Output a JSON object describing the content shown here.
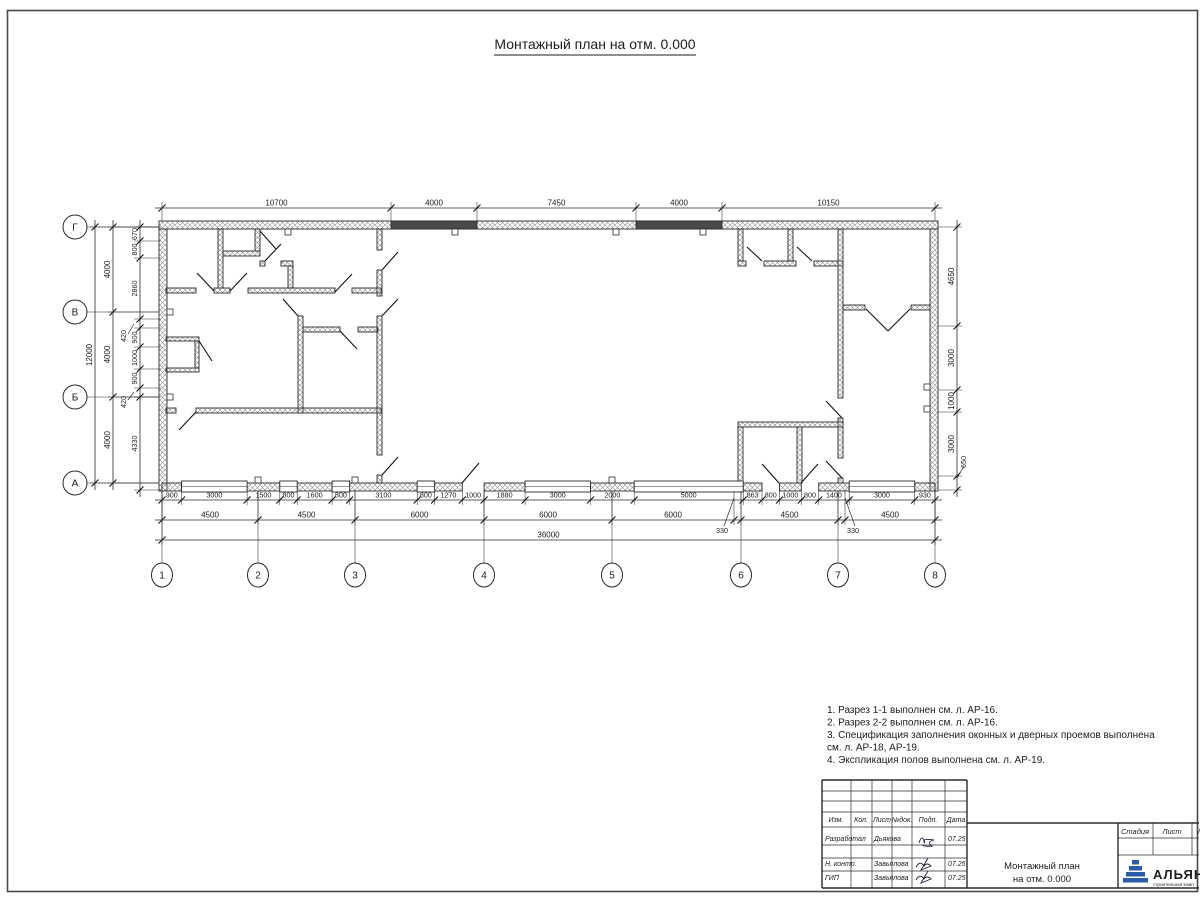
{
  "sheet": {
    "title": "Монтажный план на отм. 0.000"
  },
  "notes": {
    "lines": [
      "1. Разрез 1-1 выполнен см. л. АР-16.",
      "2. Разрез 2-2 выполнен см. л. АР-16.",
      "3. Спецификация заполнения оконных и дверных проемов выполнена",
      "см. л. АР-18, АР-19.",
      "4. Экспликация полов выполнена см. л. АР-19."
    ]
  },
  "tb": {
    "header_cols": [
      "Изм.",
      "Кол.",
      "Лист",
      "№док.",
      "Подп.",
      "Дата"
    ],
    "rows": [
      {
        "role": "Разработал",
        "name": "Дьякова",
        "date": "07.25"
      },
      {
        "role": "Н. контр.",
        "name": "Завьялова",
        "date": "07.25"
      },
      {
        "role": "ГИП",
        "name": "Завьялова",
        "date": "07.25"
      }
    ],
    "doc1": "Монтажный план",
    "doc2": "на отм. 0.000",
    "stage": [
      "Стадия",
      "Лист",
      "Лист"
    ],
    "logo": "АЛЬЯН",
    "tagline": "строительная комп"
  },
  "plan": {
    "col_axes": [
      {
        "label": "1",
        "x": 162
      },
      {
        "label": "2",
        "x": 258
      },
      {
        "label": "3",
        "x": 355
      },
      {
        "label": "4",
        "x": 484
      },
      {
        "label": "5",
        "x": 612
      },
      {
        "label": "6",
        "x": 741
      },
      {
        "label": "7",
        "x": 838
      },
      {
        "label": "8",
        "x": 935
      }
    ],
    "row_axes": [
      {
        "label": "Г",
        "y": 227
      },
      {
        "label": "В",
        "y": 312
      },
      {
        "label": "Б",
        "y": 397
      },
      {
        "label": "А",
        "y": 483
      }
    ],
    "axis_circle_r": 12,
    "col_circle_y": 575,
    "row_circle_x": 75,
    "walls_hatch": [
      [
        159,
        221,
        779,
        8
      ],
      [
        159,
        229,
        8,
        262
      ],
      [
        930,
        229,
        8,
        262
      ],
      [
        162,
        483,
        19.6,
        8
      ],
      [
        247.1,
        483,
        32.7,
        8
      ],
      [
        297.2,
        483,
        34.9,
        8
      ],
      [
        349.6,
        483,
        67.6,
        8
      ],
      [
        434.6,
        483,
        27.7,
        8
      ],
      [
        484.1,
        483,
        41,
        8
      ],
      [
        590.5,
        483,
        43.7,
        8
      ],
      [
        743.2,
        483,
        18.8,
        8
      ],
      [
        779.5,
        483,
        21.8,
        8
      ],
      [
        818.7,
        483,
        30.5,
        8
      ],
      [
        914.7,
        483,
        20.3,
        8
      ],
      [
        166,
        288,
        30,
        5
      ],
      [
        214,
        288,
        16,
        5
      ],
      [
        248,
        288,
        87,
        5
      ],
      [
        352,
        288,
        29,
        5
      ],
      [
        218,
        229,
        5,
        59
      ],
      [
        223,
        251,
        37,
        5
      ],
      [
        255,
        229,
        5,
        22
      ],
      [
        260,
        261,
        5,
        5
      ],
      [
        281,
        261,
        12,
        5
      ],
      [
        288,
        266,
        5,
        22
      ],
      [
        298,
        316,
        5,
        97
      ],
      [
        303,
        327,
        37,
        5
      ],
      [
        358,
        327,
        20,
        5
      ],
      [
        166,
        408,
        10,
        5
      ],
      [
        196,
        408,
        185,
        5
      ],
      [
        377,
        229,
        5,
        21
      ],
      [
        377,
        270,
        5,
        26
      ],
      [
        377,
        316,
        5,
        139
      ],
      [
        377,
        475,
        5,
        8
      ],
      [
        738,
        229,
        5,
        32
      ],
      [
        788,
        229,
        5,
        32
      ],
      [
        738,
        261,
        8,
        5
      ],
      [
        764,
        261,
        32,
        5
      ],
      [
        814,
        261,
        29,
        5
      ],
      [
        838,
        229,
        5,
        169
      ],
      [
        838,
        418,
        5,
        40
      ],
      [
        838,
        478,
        5,
        5
      ],
      [
        843,
        305,
        22,
        5
      ],
      [
        911,
        305,
        19,
        5
      ],
      [
        738,
        422,
        105,
        5
      ],
      [
        738,
        427,
        5,
        56
      ],
      [
        797,
        427,
        5,
        56
      ],
      [
        166,
        337,
        33,
        4
      ],
      [
        195,
        341,
        4,
        27
      ],
      [
        166,
        368,
        33,
        4
      ]
    ],
    "walls_solid": [
      [
        391,
        221,
        86,
        8
      ],
      [
        636,
        221,
        86,
        8
      ]
    ],
    "windows": [
      [
        181.6,
        65.5
      ],
      [
        279.8,
        17.4
      ],
      [
        332.1,
        17.5
      ],
      [
        417.2,
        17.4
      ],
      [
        525.1,
        65.4
      ],
      [
        634.2,
        109
      ],
      [
        849.2,
        65.5
      ]
    ],
    "window_y": 481,
    "window_h": 11,
    "doors": [
      [
        214,
        291,
        197,
        273
      ],
      [
        230,
        291,
        247,
        273
      ],
      [
        335,
        292,
        352,
        274
      ],
      [
        265,
        261,
        281,
        244
      ],
      [
        298,
        316,
        283,
        299
      ],
      [
        340,
        331,
        357,
        349
      ],
      [
        196,
        412,
        179,
        430
      ],
      [
        382,
        270,
        398,
        252
      ],
      [
        382,
        316,
        398,
        299
      ],
      [
        382,
        475,
        398,
        457
      ],
      [
        260,
        231,
        276,
        249
      ],
      [
        762,
        261,
        747,
        247
      ],
      [
        812,
        261,
        797,
        247
      ],
      [
        842,
        418,
        826,
        401
      ],
      [
        842,
        478,
        826,
        461
      ],
      [
        866,
        309,
        888,
        331
      ],
      [
        910,
        309,
        888,
        331
      ],
      [
        462,
        483,
        479,
        463
      ],
      [
        779,
        483,
        762,
        464
      ],
      [
        801,
        483,
        818,
        464
      ],
      [
        199,
        341,
        212,
        361
      ]
    ],
    "marks": [
      [
        285,
        229
      ],
      [
        452,
        229
      ],
      [
        613,
        229
      ],
      [
        700,
        229
      ],
      [
        167,
        309
      ],
      [
        167,
        394
      ],
      [
        924,
        384
      ],
      [
        924,
        406
      ],
      [
        255,
        477
      ],
      [
        352,
        477
      ],
      [
        609,
        477
      ]
    ],
    "dim_chains": [
      {
        "dir": "h",
        "pos": 208,
        "fs": 8,
        "ticks": [
          162,
          391,
          477,
          636,
          722,
          935
        ],
        "labels": [
          "10700",
          "4000",
          "7450",
          "4000",
          "10150"
        ],
        "ext": [
          202,
          221
        ]
      },
      {
        "dir": "h",
        "pos": 500,
        "fs": 7.2,
        "ticks": [
          162,
          181.6,
          247.1,
          279.8,
          297.2,
          332.1,
          349.6,
          417.2,
          434.6,
          462.3,
          484.1,
          525.1,
          590.5,
          634.2,
          743.2,
          762,
          779.5,
          801.3,
          818.7,
          849.2,
          914.7,
          935
        ],
        "labels": [
          "900",
          "3000",
          "1500",
          "800",
          "1600",
          "800",
          "3100",
          "800",
          "1270",
          "1000",
          "1880",
          "3000",
          "2000",
          "5000",
          "863",
          "800",
          "1000",
          "800",
          "1400",
          "3000",
          "930"
        ],
        "ext": [
          491,
          505
        ]
      },
      {
        "dir": "h",
        "pos": 520,
        "fs": 8,
        "ticks": [
          162,
          258,
          355,
          484,
          612,
          734,
          741,
          838,
          845,
          935
        ],
        "labels": [
          "4500",
          "4500",
          "6000",
          "6000",
          "6000",
          "",
          "4500",
          "",
          "4500"
        ],
        "ext": [
          491,
          525
        ]
      },
      {
        "dir": "h",
        "pos": 540,
        "fs": 8,
        "ticks": [
          162,
          935
        ],
        "labels": [
          "36000"
        ],
        "ext": [
          491,
          545
        ]
      },
      {
        "dir": "v",
        "pos": 95,
        "fs": 8,
        "ticks": [
          227,
          483
        ],
        "labels": [
          "12000"
        ],
        "ext": [
          90,
          159
        ]
      },
      {
        "dir": "v",
        "pos": 113,
        "fs": 8,
        "ticks": [
          227,
          312,
          397,
          483
        ],
        "labels": [
          "4000",
          "4000",
          "4000"
        ],
        "ext": [
          108,
          159
        ]
      },
      {
        "dir": "v",
        "pos": 140,
        "fs": 7.2,
        "ticks": [
          227,
          241,
          258,
          319,
          328,
          347,
          369,
          388,
          397,
          490
        ],
        "labels": [
          "670",
          "800",
          "2860",
          "",
          "900",
          "1000",
          "900",
          "",
          "4330"
        ],
        "ext": [
          134,
          161
        ]
      },
      {
        "dir": "v",
        "pos": 957,
        "fs": 8,
        "ticks": [
          227,
          326,
          390,
          412,
          476,
          490
        ],
        "labels": [
          "4650",
          "3000",
          "1000",
          "3000",
          ""
        ],
        "ext": [
          938,
          962
        ]
      }
    ],
    "leaders": [
      {
        "x1": 734,
        "y1": 498,
        "x2": 724,
        "y2": 526,
        "tx": 722,
        "ty": 533,
        "text": "330",
        "rot": 0
      },
      {
        "x1": 845,
        "y1": 498,
        "x2": 855,
        "y2": 526,
        "tx": 853,
        "ty": 533,
        "text": "330",
        "rot": 0
      },
      {
        "x1": 134,
        "y1": 324,
        "x2": 128,
        "y2": 334,
        "tx": 126,
        "ty": 336,
        "text": "420",
        "rot": -90
      },
      {
        "x1": 134,
        "y1": 392,
        "x2": 128,
        "y2": 400,
        "tx": 126,
        "ty": 402,
        "text": "420",
        "rot": -90
      },
      {
        "x1": 957,
        "y1": 478,
        "x2": 964,
        "y2": 466,
        "tx": 966,
        "ty": 462,
        "text": "650",
        "rot": -90
      }
    ]
  }
}
